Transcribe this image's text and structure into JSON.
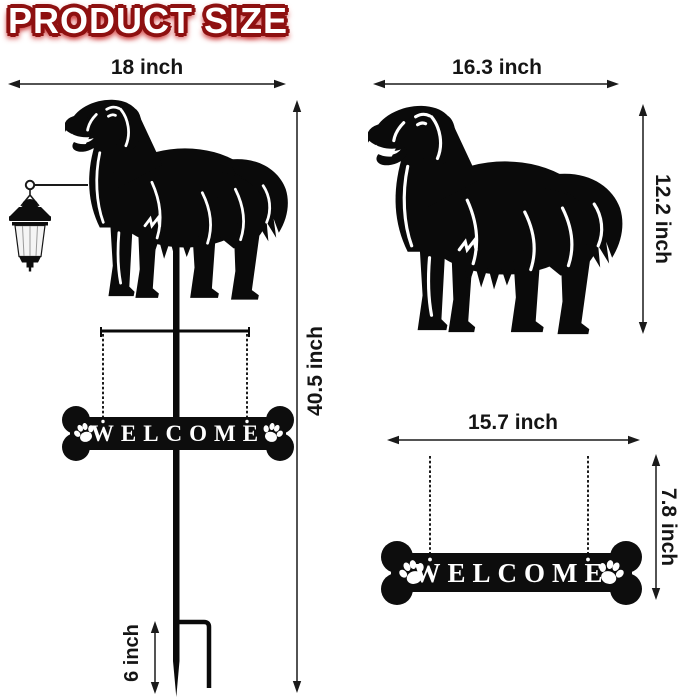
{
  "title": "PRODUCT SIZE",
  "sign_text": "WELCOME",
  "measurements": {
    "full_stake_width": "18 inch",
    "full_stake_height": "40.5 inch",
    "ground_stake_depth": "6 inch",
    "dog_panel_width": "16.3 inch",
    "dog_panel_height": "12.2 inch",
    "welcome_sign_width": "15.7 inch",
    "welcome_sign_height": "7.8 inch"
  },
  "colors": {
    "background": "#ffffff",
    "silhouette": "#0a0a0a",
    "title_fill": "#ffffff",
    "title_outline": "#8e1010",
    "title_glow": "#cc3333",
    "dimension_ink": "#1a1a1a",
    "lantern_glass": "#f4f4f4",
    "sign_letters": "#ffffff"
  },
  "icons": {
    "dog": "golden-retriever-silhouette",
    "lantern": "solar-lantern-icon",
    "sign": "bone-welcome-sign",
    "paw": "paw-print-icon",
    "stake": "ground-stake",
    "chain": "hanging-chain",
    "dimension_arrow": "double-arrow-dimension-line"
  }
}
